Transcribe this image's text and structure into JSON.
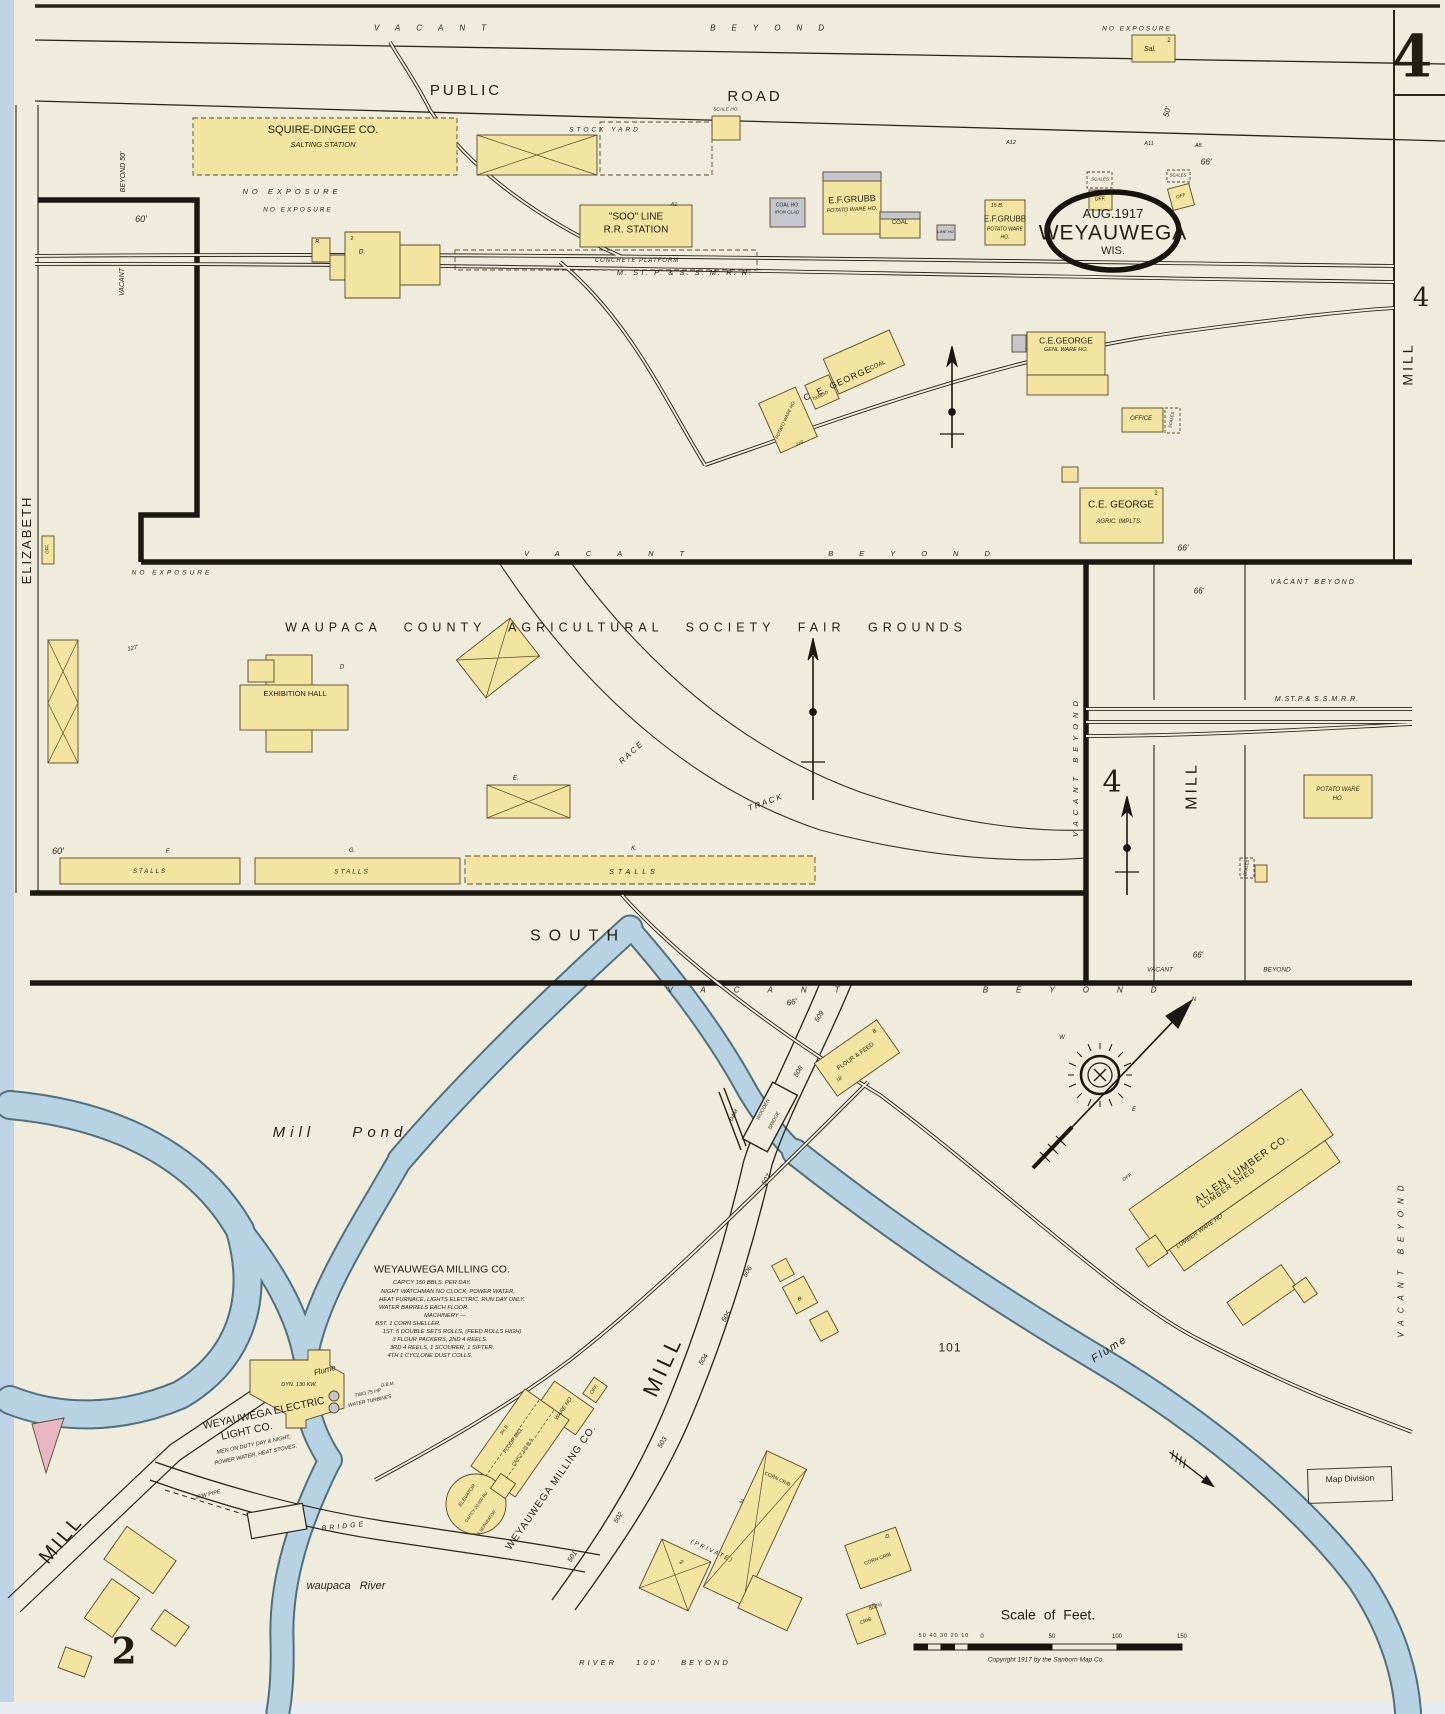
{
  "map": {
    "type": "Sanborn fire insurance map",
    "stamp": {
      "date": "AUG.1917",
      "city": "WEYAUWEGA",
      "state": "WIS."
    },
    "sheet_number": "4",
    "adjacent_sheet_number": "2",
    "scale": {
      "title": "Scale of Feet.",
      "left_ticks": "50 40 30 20 10",
      "zero": "0",
      "t50": "50",
      "t100": "100",
      "t150": "150"
    },
    "copyright": "Copyright 1917 by the Sanborn Map Co.",
    "stamp_box": "Map Division"
  },
  "labels": {
    "vacant_beyond_top": "VACANT BEYOND",
    "no_exposure_tr": "NO EXPOSURE",
    "sal": "Sal.",
    "sal_storeys": "2",
    "beyond_50_v": "BEYOND 50'",
    "vacant_v1": "VACANT",
    "public": "PUBLIC",
    "road": "ROAD",
    "squire_dingee": "SQUIRE-DINGEE CO.",
    "salting_station": "SALTING STATION",
    "stock_yard": "STOCK YARD",
    "scale_ho": "SCALE HO.",
    "no_exposure_1": "NO EXPOSURE",
    "no_exposure_2": "NO EXPOSURE",
    "dim_60_top": "60'",
    "r_mark": "R.",
    "d_mark": "D.",
    "d_storeys": "2",
    "soo_line_1": "\"SOO\" LINE",
    "soo_line_2": "R.R. STATION",
    "a1_mark": "A1",
    "concrete_platform": "CONCRETE PLATFORM",
    "railroad_main_label": "M. ST. P. & S. S. M. R. R.",
    "grubb1_name": "E.F.GRUBB",
    "grubb1_use": "POTATO WARE HO.",
    "coal_ho_1": "COAL HO",
    "iron_clad": "IRON CLAD",
    "coal_2": "COAL",
    "lime_ho": "LIME HO.",
    "grubb2_mark": "15 B.",
    "grubb2_name": "E.F.GRUBB",
    "grubb2_use1": "POTATO WARE",
    "grubb2_use2": "HO.",
    "scales_1": "SCALES",
    "off_1": "OFF.",
    "scales_2": "SCALES",
    "off_2": "OFF",
    "a12": "A12",
    "a11": "A11",
    "a8": "A8.",
    "dim_66_1": "66'",
    "dim_50_rot": "50'",
    "block4_top": "4",
    "mill_top": "MILL",
    "george_cluster_name": "C. E. GEORGE",
    "george_cluster_coal": "COAL",
    "george_cluster_cement": "CEMENT",
    "george_cluster_potato": "POTATO WARE HO.",
    "george_cluster_dim": "218'",
    "george_main_name": "C.E.GEORGE",
    "george_main_use": "GENL WARE HO.",
    "office_1": "OFFICE",
    "scales_3": "SCALES",
    "george_impl_name": "C.E. GEORGE",
    "george_impl_use": "AGRIC. IMPLTS.",
    "george_impl_storeys": "2",
    "dim_66_3": "66'",
    "elizabeth": "ELIZABETH",
    "off_3": "OFF.",
    "no_exposure_3": "NO EXPOSURE",
    "vacant_beyond_fair": "VACANT BEYOND",
    "fairgrounds_title": "WAUPACA COUNTY AGRICULTURAL SOCIETY FAIR GROUNDS",
    "exhibition_hall": "EXHIBITION HALL",
    "d_mark_2": "D",
    "race": "RACE",
    "track": "TRACK",
    "dim_127": "127'",
    "e_mark": "E.",
    "f_mark": "F.",
    "g_mark": "G.",
    "k_mark": "K.",
    "stalls_1": "STALLS",
    "stalls_2": "STALLS",
    "stalls_3": "STALLS",
    "dim_60_2": "60'",
    "south": "SOUTH",
    "vacant_beyond_v1": "VACANT BEYOND",
    "block4_mid": "4",
    "mill_mid": "MILL",
    "railroad_mid_label": "M.ST.P.& S.S.M.R.R.",
    "potato_ware_1": "POTATO WARE",
    "potato_ware_2": "HO.",
    "scales_4": "SCALES",
    "dim_66_4": "66'",
    "vacant_beyond_mid_top": "VACANT BEYOND",
    "vacant_mid_bot": "VACANT",
    "beyond_mid_bot": "BEYOND",
    "dim_66_5": "66'",
    "dim_66_6": "66'",
    "vacant_beyond_street": "VACANT BEYOND",
    "vacant_beyond_v2": "VACANT BEYOND",
    "mill_pond": "Mill Pond",
    "n509": "509",
    "n508": "508",
    "n507": "507",
    "n506": "506",
    "n505": "505",
    "n504": "504",
    "n503": "503",
    "n502": "502",
    "n501": "501",
    "dam": "DAM",
    "wooden": "WOODEN",
    "bridge_w": "BRIDGE",
    "flour_feed": "FLOUR & FEED",
    "flour_feed_mark": "B.",
    "dim_18": "18'",
    "compass_n": "N",
    "compass_w": "W",
    "compass_e": "E",
    "allen_name": "ALLEN LUMBER CO.",
    "allen_use": "LUMBER SHED",
    "lumber_ware": "LUMBER WARE HO",
    "off_4": "OFF.",
    "milling_title": "WEYAUWEGA MILLING CO.",
    "milling_l1": "CAP'CY 150 BBLS. PER DAY.",
    "milling_l2": "NIGHT WATCHMAN NO CLOCK, POWER WATER,",
    "milling_l3": "HEAT FURNACE, LIGHTS ELECTRIC. RUN DAY ONLY.",
    "milling_l4": "WATER BARRELS EACH FLOOR.",
    "milling_l5": "MACHINERY —",
    "milling_l6": "BST. 1 CORN SHELLER.",
    "milling_l7": "1ST. 5 DOUBLE SETS ROLLS, (FEED ROLLS HIGH)",
    "milling_l8": "3 FLOUR PACKERS, 2ND 4 REELS.",
    "milling_l9": "3RD 4 REELS, 1 SCOURER, 1 SIFTER.",
    "milling_l10": "4TH 1 CYCLONE DUST COLLS.",
    "mill_street_label": "WEYAUWEGA MILLING CO.",
    "ware_ho": "WARE HO.",
    "off_5": "OFF.",
    "flour_mill_1": "3½ B.",
    "flour_mill_2": "FLOUR MILL",
    "flour_mill_3": "CAP'CY 125 BLS.",
    "elevator_1": "ELEVATOR",
    "elevator_2": "CAP'CY 20,000 BU.",
    "elevator_3": "1 SEPARATOR",
    "flume_1": "Flume",
    "flume_2": "Flume",
    "dyn": "DYN. 130 KW.",
    "dbm": "D.B.M.",
    "turbines_1": "TWO 75 HP",
    "turbines_2": "WATER TURBINES",
    "electric_1": "WEYAUWEGA ELECTRIC",
    "electric_2": "LIGHT CO.",
    "electric_3": "MEN ON DUTY DAY & NIGHT,",
    "electric_4": "POWER WATER, HEAT STOVES.",
    "mill_st_1": "MILL",
    "mill_st_2": "MILL",
    "pipe": "33'W PIPE",
    "bridge": "BRIDGE",
    "waupaca_river": "waupaca River",
    "river_beyond": "RIVER 100' BEYOND",
    "private": "(PRIVATE)",
    "barn2_a": "2",
    "barn2_b": "2",
    "corn_crib_1": "CORN CRIB",
    "corn_crib_2": "CORN CRIB",
    "crib_num": "502½",
    "crib": "CRIB",
    "d_mark_3": "D.",
    "b_mark": "B.",
    "block_101": "101"
  }
}
